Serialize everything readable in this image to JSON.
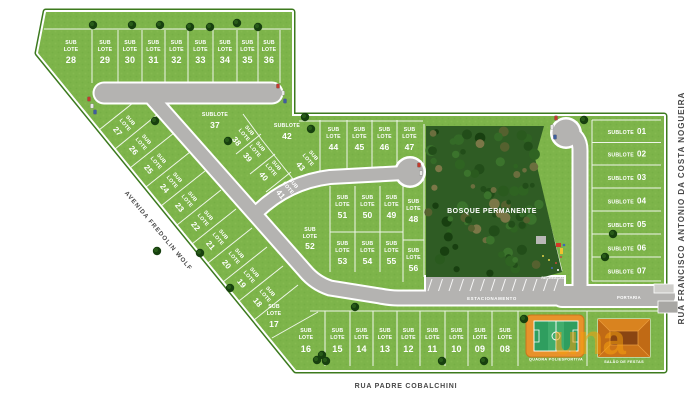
{
  "streets": {
    "left": "AVENIDA FREDOLIN WOLF",
    "bottom": "RUA PADRE COBALCHINI",
    "right": "RUA FRANCISCO ANTONIO DA COSTA NOGUEIRA"
  },
  "labels": {
    "sub": "SUB",
    "lote": "LOTE",
    "sublote": "SUBLOTE"
  },
  "areas": {
    "forest": "BOSQUE PERMANENTE",
    "parking": "ESTACIONAMENTO",
    "recreation": "RECREAÇÃO",
    "gatehouse": "PORTARIA",
    "sports_court": "QUADRA POLIESPORTIVA",
    "party_hall": "SALÃO DE FESTAS"
  },
  "watermark": "una",
  "lots": {
    "top": [
      "28",
      "29",
      "30",
      "31",
      "32",
      "33",
      "34",
      "35",
      "36"
    ],
    "left_diagonal": [
      "27",
      "26",
      "25",
      "24",
      "23",
      "22",
      "21",
      "20",
      "19",
      "18"
    ],
    "mid_rotated": [
      "38",
      "39",
      "40",
      "41",
      "43"
    ],
    "islands": {
      "i37": "37",
      "i42": "42",
      "i48": "48",
      "i52": "52",
      "i56": "56",
      "i17": "17",
      "i16": "16"
    },
    "row_upper": [
      "44",
      "45",
      "46",
      "47"
    ],
    "row_mid": [
      "51",
      "50",
      "49"
    ],
    "row_lower": [
      "53",
      "54",
      "55"
    ],
    "bottom": [
      "15",
      "14",
      "13",
      "12",
      "11",
      "10",
      "09",
      "08"
    ],
    "right_column": [
      "01",
      "02",
      "03",
      "04",
      "05",
      "06",
      "07"
    ]
  },
  "colors": {
    "grass": "#7db44a",
    "road": "#b4b3b1",
    "forest_base": "#2f5c24",
    "boundary_green": "#3c7a1e",
    "accent_orange": "#e8922b",
    "watermark_orange": "#f59f0f",
    "court_green": "#2f9e5f"
  }
}
